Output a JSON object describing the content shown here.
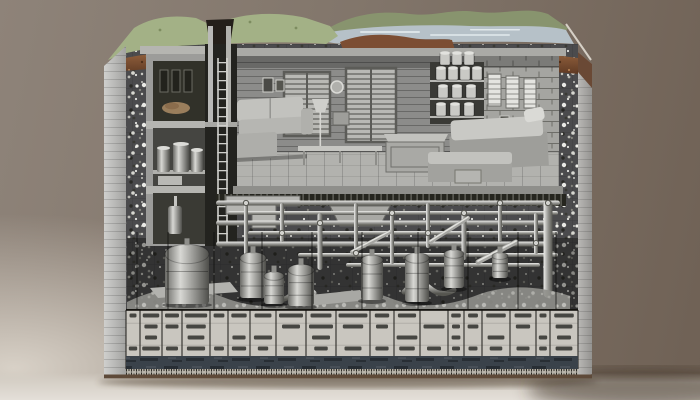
{
  "colors": {
    "background_top_left": "#8e8379",
    "background_right": "#6f6155",
    "background_bottom": "#d8d1c7",
    "grass": "#a3b186",
    "hills": "#88946e",
    "water": "#b6c1c8",
    "topsoil": "#8a5a3c",
    "topsoil_dark": "#5f3a24",
    "gravel": "#4b4b4d",
    "concrete_light": "#b9b9b7",
    "room_wall": "#8c8c8a",
    "room_floor": "#b2b2ae",
    "pipe_metal": "#a5a5a1",
    "table_cell": "#c9c6bf",
    "table_ink": "#2a2a26",
    "water_band": "#3a424a",
    "ruler": "#b7b3aa",
    "block_shadow": "#3a2f23"
  },
  "collections": {
    "pipes": {
      "h": [
        [
          216,
          560,
          203,
          5
        ],
        [
          228,
          558,
          213,
          4
        ],
        [
          216,
          546,
          223,
          5
        ],
        [
          248,
          558,
          233,
          4
        ],
        [
          216,
          552,
          244,
          5
        ],
        [
          298,
          558,
          255,
          4
        ],
        [
          346,
          540,
          265,
          4
        ]
      ],
      "v": [
        [
          246,
          203,
          260,
          4
        ],
        [
          282,
          203,
          242,
          4
        ],
        [
          320,
          213,
          270,
          5
        ],
        [
          356,
          203,
          254,
          4
        ],
        [
          392,
          213,
          264,
          4
        ],
        [
          428,
          203,
          248,
          4
        ],
        [
          464,
          213,
          260,
          5
        ],
        [
          500,
          203,
          242,
          4
        ],
        [
          536,
          213,
          254,
          4
        ],
        [
          548,
          200,
          298,
          9
        ]
      ],
      "d": [
        [
          352,
          252,
          390,
          232,
          4
        ],
        [
          430,
          242,
          468,
          218,
          4
        ],
        [
          478,
          262,
          516,
          242,
          5
        ]
      ],
      "joints": [
        [
          246,
          203
        ],
        [
          282,
          233
        ],
        [
          320,
          223
        ],
        [
          356,
          253
        ],
        [
          392,
          213
        ],
        [
          428,
          233
        ],
        [
          464,
          213
        ],
        [
          500,
          203
        ],
        [
          536,
          243
        ],
        [
          548,
          203
        ]
      ]
    },
    "tanks": [
      [
        165,
        254,
        44,
        50
      ],
      [
        240,
        258,
        26,
        40
      ],
      [
        264,
        276,
        20,
        28
      ],
      [
        288,
        270,
        26,
        36
      ],
      [
        361,
        260,
        22,
        40
      ],
      [
        405,
        258,
        24,
        44
      ],
      [
        444,
        254,
        20,
        34
      ],
      [
        492,
        256,
        16,
        22
      ]
    ],
    "survey_lines": [
      137,
      168,
      214,
      262,
      312,
      362,
      418,
      468,
      518,
      556
    ],
    "ladder": {
      "rail_x1": 217.2,
      "rail_x2": 226.2,
      "top": 58,
      "bottom": 242,
      "rung_spacing": 9
    },
    "cans": [
      [
        436,
        68
      ],
      [
        448,
        68
      ],
      [
        460,
        68
      ],
      [
        472,
        68
      ],
      [
        438,
        86
      ],
      [
        452,
        86
      ],
      [
        466,
        86
      ],
      [
        436,
        104
      ],
      [
        450,
        104
      ],
      [
        464,
        104
      ],
      [
        440,
        53
      ],
      [
        452,
        53
      ],
      [
        464,
        53
      ]
    ],
    "can_size": [
      10,
      12
    ],
    "canisters": [
      [
        157,
        148,
        13,
        24
      ],
      [
        173,
        144,
        16,
        28
      ],
      [
        191,
        150,
        12,
        22
      ]
    ],
    "table": {
      "x": 126,
      "right": 578,
      "top": 310,
      "border_bottom": 369,
      "rows_y": [
        313.5,
        324.5,
        335.5,
        346.5
      ],
      "blob_h": 4,
      "columns": [
        {
          "w": 14,
          "blobs": [
            [
              0,
              0.5
            ],
            [
              3,
              0.6
            ]
          ]
        },
        {
          "w": 22,
          "blobs": [
            [
              0,
              0.75
            ],
            [
              1,
              0.6
            ],
            [
              2,
              0.55
            ],
            [
              3,
              0.8
            ]
          ]
        },
        {
          "w": 20,
          "blobs": [
            [
              0,
              0.7
            ],
            [
              1,
              0.65
            ],
            [
              3,
              0.6
            ]
          ]
        },
        {
          "w": 28,
          "blobs": [
            [
              0,
              0.8
            ],
            [
              1,
              0.7
            ],
            [
              2,
              0.6
            ],
            [
              3,
              0.65
            ]
          ]
        },
        {
          "w": 18,
          "blobs": [
            [
              0,
              0.6
            ],
            [
              3,
              0.55
            ]
          ]
        },
        {
          "w": 22,
          "blobs": [
            [
              0,
              0.7
            ],
            [
              2,
              0.6
            ],
            [
              3,
              0.65
            ]
          ]
        },
        {
          "w": 26,
          "blobs": [
            [
              0,
              0.65
            ],
            [
              2,
              0.7
            ],
            [
              3,
              0.4
            ]
          ]
        },
        {
          "w": 30,
          "blobs": [
            [
              0,
              0.8
            ],
            [
              1,
              0.6
            ],
            [
              3,
              0.5
            ]
          ]
        },
        {
          "w": 30,
          "blobs": [
            [
              0,
              0.7
            ],
            [
              1,
              0.8
            ],
            [
              2,
              0.6
            ],
            [
              3,
              0.45
            ]
          ]
        },
        {
          "w": 34,
          "blobs": [
            [
              0,
              0.85
            ],
            [
              1,
              0.6
            ],
            [
              3,
              0.5
            ]
          ]
        },
        {
          "w": 24,
          "blobs": [
            [
              0,
              0.6
            ],
            [
              1,
              0.5
            ],
            [
              3,
              0.55
            ]
          ]
        },
        {
          "w": 26,
          "blobs": [
            [
              0,
              0.7
            ],
            [
              2,
              0.8
            ],
            [
              3,
              0.6
            ]
          ]
        },
        {
          "w": 28,
          "blobs": [
            [
              1,
              0.75
            ],
            [
              3,
              0.5
            ]
          ]
        },
        {
          "w": 16,
          "blobs": [
            [
              0,
              0.6
            ],
            [
              1,
              0.5
            ],
            [
              2,
              0.55
            ],
            [
              3,
              0.5
            ]
          ]
        },
        {
          "w": 18,
          "blobs": [
            [
              0,
              0.55
            ],
            [
              1,
              0.6
            ],
            [
              3,
              0.5
            ]
          ]
        },
        {
          "w": 28,
          "blobs": [
            [
              0,
              0.7
            ],
            [
              2,
              0.6
            ],
            [
              3,
              0.45
            ]
          ]
        },
        {
          "w": 26,
          "blobs": [
            [
              0,
              0.65
            ],
            [
              1,
              0.55
            ],
            [
              3,
              0.5
            ]
          ]
        },
        {
          "w": 14,
          "blobs": [
            [
              0,
              0.5
            ],
            [
              2,
              0.6
            ],
            [
              3,
              0.55
            ]
          ]
        },
        {
          "w": 28,
          "blobs": [
            [
              0,
              0.7
            ],
            [
              1,
              0.6
            ],
            [
              2,
              0.5
            ],
            [
              3,
              0.6
            ]
          ]
        }
      ]
    }
  }
}
